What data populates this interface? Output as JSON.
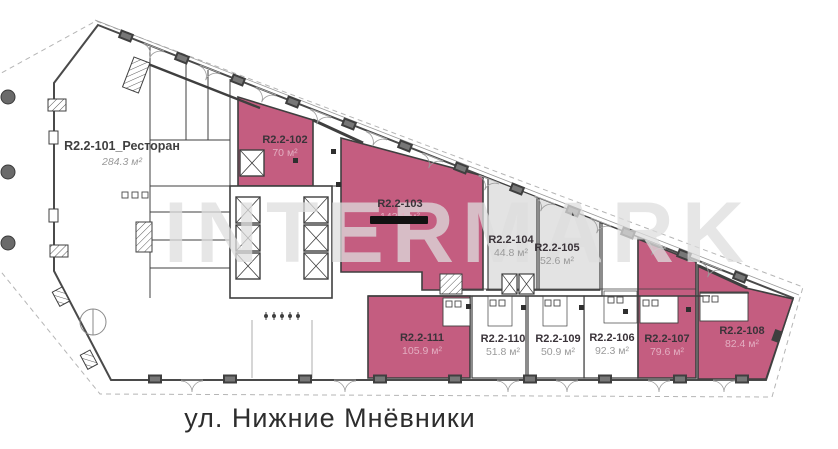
{
  "street_label": "ул. Нижние Мнёвники",
  "watermark": "INTERMARK",
  "colors": {
    "unit_highlight": "#c45d80",
    "unit_gray": "#e3e3e3",
    "walls": "#3f3f3f",
    "boundary_dash": "#b5b5b5"
  },
  "units": [
    {
      "id": "R2.2-101_Ресторан",
      "area": "284.3 м²",
      "status": "available-white"
    },
    {
      "id": "R2.2-102",
      "area": "70 м²",
      "status": "highlighted-pink"
    },
    {
      "id": "R2.2-103",
      "area": "143.1 м²",
      "status": "highlighted-pink-struck"
    },
    {
      "id": "R2.2-104",
      "area": "44.8 м²",
      "status": "gray"
    },
    {
      "id": "R2.2-105",
      "area": "52.6 м²",
      "status": "gray"
    },
    {
      "id": "R2.2-106",
      "area": "92.3 м²",
      "status": "available-white"
    },
    {
      "id": "R2.2-107",
      "area": "79.6 м²",
      "status": "highlighted-pink"
    },
    {
      "id": "R2.2-108",
      "area": "82.4 м²",
      "status": "highlighted-pink"
    },
    {
      "id": "R2.2-109",
      "area": "50.9 м²",
      "status": "available-white"
    },
    {
      "id": "R2.2-110",
      "area": "51.8 м²",
      "status": "available-white"
    },
    {
      "id": "R2.2-111",
      "area": "105.9 м²",
      "status": "highlighted-pink"
    }
  ]
}
